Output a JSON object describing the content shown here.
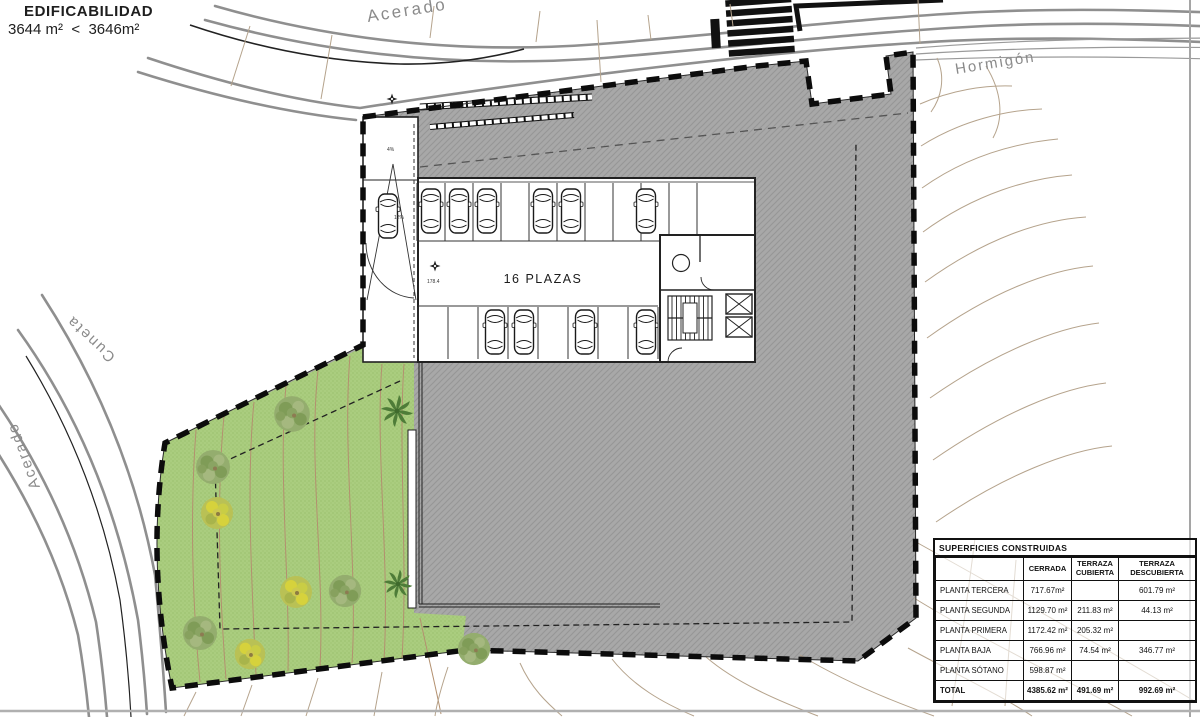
{
  "edificabilidad": {
    "line1": "EDIFICABILIDAD",
    "line2": "3644 m²  <  3646m²"
  },
  "labels": {
    "road_top": "Acerado",
    "road_left_outer": "Acerado",
    "road_left_inner": "Cuneta",
    "road_right": "Hormigón",
    "parking_count": "16 PLAZAS",
    "ramp_slope_upper": "4%",
    "ramp_slope_lower": "12%",
    "level_point": "178.4"
  },
  "table": {
    "title": "SUPERFICIES CONSTRUIDAS",
    "columns": [
      "CERRADA",
      "TERRAZA CUBIERTA",
      "TERRAZA DESCUBIERTA"
    ],
    "rows": [
      {
        "label": "PLANTA TERCERA",
        "values": [
          "717.67m²",
          "",
          "601.79 m²"
        ]
      },
      {
        "label": "PLANTA SEGUNDA",
        "values": [
          "1129.70 m²",
          "211.83 m²",
          "44.13 m²"
        ]
      },
      {
        "label": "PLANTA PRIMERA",
        "values": [
          "1172.42 m²",
          "205.32 m²",
          ""
        ]
      },
      {
        "label": "PLANTA BAJA",
        "values": [
          "766.96 m²",
          "74.54 m²",
          "346.77 m²"
        ]
      },
      {
        "label": "PLANTA SÓTANO",
        "values": [
          "598.87 m²",
          "",
          ""
        ]
      },
      {
        "label": "TOTAL",
        "values": [
          "4385.62 m²",
          "491.69 m²",
          "992.69 m²"
        ]
      }
    ]
  },
  "colors": {
    "site_fill": "#a8a8a8",
    "green_fill": "#aacd7f",
    "boundary": "#0c0c0c",
    "road": "#8f8f8f",
    "contour": "#b5a38c"
  }
}
